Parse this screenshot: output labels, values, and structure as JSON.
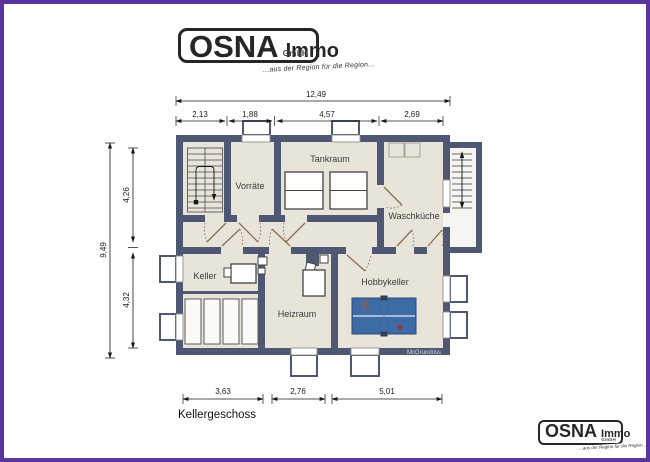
{
  "page": {
    "frame_color": "#5a35a0",
    "background": "#ffffff"
  },
  "logo": {
    "brand": "OSNA",
    "brand_suffix": "Immo",
    "company_form": "GmbH",
    "tagline": "...aus der Region für die Region..."
  },
  "plan": {
    "floor_label": "Kellergeschoss",
    "watermark": "McGrundriss",
    "rooms": {
      "vorraete": "Vorräte",
      "tankraum": "Tankraum",
      "waschkueche": "Waschküche",
      "keller": "Keller",
      "heizraum": "Heizraum",
      "hobbykeller": "Hobbykeller"
    },
    "colors": {
      "wall": "#4e5872",
      "floor": "#e9e4da",
      "door": "#8a6f52",
      "table": "#3d6ba6"
    }
  },
  "dimensions": {
    "top_total": "12,49",
    "top_segments": [
      "2,13",
      "1,88",
      "4,57",
      "2,69"
    ],
    "left_total": "9,49",
    "left_segments": [
      "4,26",
      "4,32"
    ],
    "bottom_segments": [
      "3,63",
      "2,76",
      "5,01"
    ]
  }
}
